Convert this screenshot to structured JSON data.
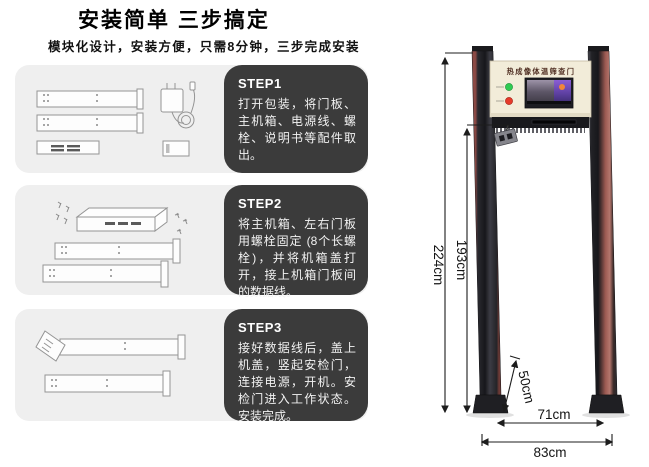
{
  "header": {
    "title": "安装简单 三步搞定",
    "subtitle": "模块化设计，安装方便，只需8分钟，三步完成安装"
  },
  "steps": [
    {
      "label": "STEP1",
      "text": "打开包装，将门板、主机箱、电源线、螺栓、说明书等配件取出。"
    },
    {
      "label": "STEP2",
      "text": "将主机箱、左右门板用螺栓固定 (8个长螺栓)，并将机箱盖打开，接上机箱门板间的数据线。"
    },
    {
      "label": "STEP3",
      "text": "接好数据线后，盖上机盖，竖起安检门，连接电源，开机。安检门进入工作状态。安装完成。"
    }
  ],
  "door_diagram": {
    "device_title": "热成像体温筛查门",
    "dimensions": {
      "outer_height": "224cm",
      "inner_height": "193cm",
      "camera_height": "50cm",
      "inner_width": "71cm",
      "outer_width": "83cm"
    },
    "icons": {
      "status_ok": "green-led",
      "status_alarm": "red-led",
      "display": "thermal-screen",
      "sensor": "thermal-camera-icon"
    },
    "colors": {
      "post_dark": "#1b1b1f",
      "post_maroon": "#8c4a45",
      "header_panel": "#f2ecd9",
      "led_green": "#2ecb52",
      "led_red": "#e6392a"
    }
  }
}
